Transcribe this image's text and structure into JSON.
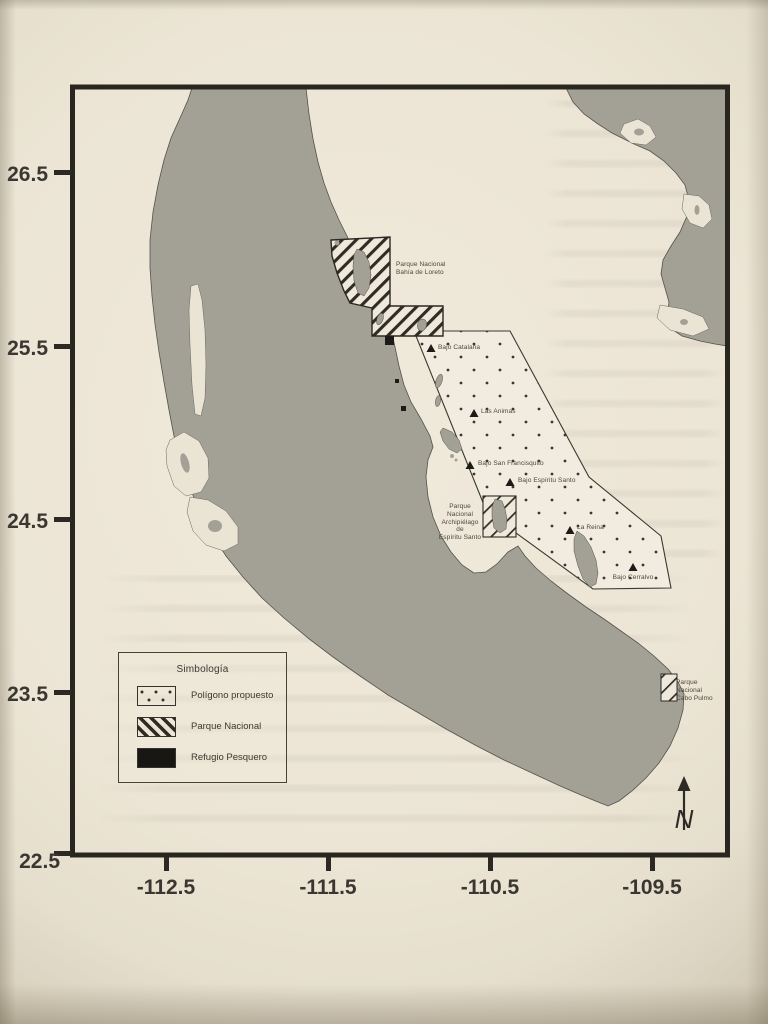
{
  "figure": {
    "axes": {
      "latitude": [
        "26.5",
        "25.5",
        "24.5",
        "23.5",
        "22.5"
      ],
      "longitude": [
        "-112.5",
        "-111.5",
        "-110.5",
        "-109.5"
      ]
    },
    "legend": {
      "title": "Simbología",
      "items": [
        {
          "label": "Polígono propuesto",
          "swatch": "dotted"
        },
        {
          "label": "Parque Nacional",
          "swatch": "hatched"
        },
        {
          "label": "Refugio Pesquero",
          "swatch": "solid-black"
        }
      ]
    },
    "parks": {
      "loreto": "Parque Nacional\nBahía de Loreto",
      "espiritu_santo": "Parque Nacional\nArchipiélago de\nEspíritu Santo",
      "cabo_pulmo": "Parque Nacional\nCabo Pulmo"
    },
    "seamounts": [
      {
        "name": "Bajo Catalana",
        "approx_lon": -110.9,
        "approx_lat": 25.5
      },
      {
        "name": "Las Animas",
        "approx_lon": -110.6,
        "approx_lat": 25.1
      },
      {
        "name": "Bajo San Francisquito",
        "approx_lon": -110.6,
        "approx_lat": 24.8
      },
      {
        "name": "Bajo Espíritu Santo",
        "approx_lon": -110.4,
        "approx_lat": 24.7
      },
      {
        "name": "La Reina",
        "approx_lon": -110.0,
        "approx_lat": 24.4
      },
      {
        "name": "Bajo Cerralvo",
        "approx_lon": -109.6,
        "approx_lat": 24.2
      }
    ],
    "north_label": "N",
    "colors": {
      "land": "#a3a196",
      "paper": "#eae4d5",
      "ink": "#2e2b25"
    }
  }
}
